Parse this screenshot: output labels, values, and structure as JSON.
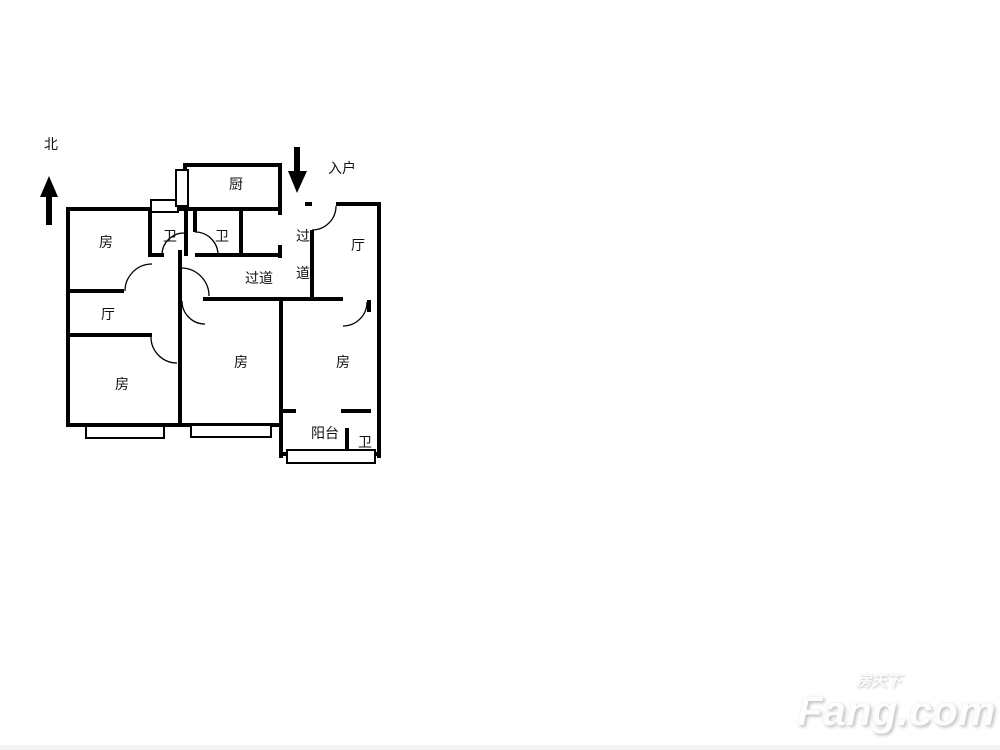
{
  "page": {
    "background": "#ffffff",
    "line_color": "#000000"
  },
  "watermark": {
    "cn": "房天下",
    "en": "Fang.com"
  },
  "plan": {
    "line_color": "#000000",
    "label_font_size": 14,
    "labels": [
      {
        "name": "north-label",
        "text": "北",
        "x": 51,
        "y": 144
      },
      {
        "name": "entry-label",
        "text": "入户",
        "x": 342,
        "y": 168
      },
      {
        "name": "kitchen-label",
        "text": "厨",
        "x": 236,
        "y": 184
      },
      {
        "name": "bath-1-label",
        "text": "卫",
        "x": 170,
        "y": 236
      },
      {
        "name": "bath-2-label",
        "text": "卫",
        "x": 222,
        "y": 236
      },
      {
        "name": "bedroom-nw-label",
        "text": "房",
        "x": 106,
        "y": 242
      },
      {
        "name": "hall-east-label",
        "text": "厅",
        "x": 358,
        "y": 245
      },
      {
        "name": "corridor-char-1",
        "text": "过",
        "x": 303,
        "y": 236
      },
      {
        "name": "corridor-char-2",
        "text": "道",
        "x": 303,
        "y": 273
      },
      {
        "name": "corridor-label",
        "text": "过道",
        "x": 259,
        "y": 278
      },
      {
        "name": "hall-west-label",
        "text": "厅",
        "x": 108,
        "y": 314
      },
      {
        "name": "bedroom-sw-label",
        "text": "房",
        "x": 122,
        "y": 384
      },
      {
        "name": "bedroom-s-label",
        "text": "房",
        "x": 241,
        "y": 362
      },
      {
        "name": "bedroom-se-label",
        "text": "房",
        "x": 343,
        "y": 362
      },
      {
        "name": "balcony-label",
        "text": "阳台",
        "x": 325,
        "y": 433
      },
      {
        "name": "bath-3-label",
        "text": "卫",
        "x": 365,
        "y": 442
      }
    ],
    "walls": [
      {
        "name": "wall-outer-left",
        "x": 66,
        "y": 207,
        "w": 4,
        "h": 220
      },
      {
        "name": "wall-nw-room-top",
        "x": 66,
        "y": 207,
        "w": 216,
        "h": 4
      },
      {
        "name": "wall-kitchen-top",
        "x": 183,
        "y": 163,
        "w": 99,
        "h": 4
      },
      {
        "name": "wall-kitchen-left-upper",
        "x": 183,
        "y": 163,
        "w": 4,
        "h": 12
      },
      {
        "name": "wall-kitchen-right-upper",
        "x": 278,
        "y": 163,
        "w": 4,
        "h": 52
      },
      {
        "name": "wall-kitchen-right-lower",
        "x": 278,
        "y": 245,
        "w": 4,
        "h": 13
      },
      {
        "name": "wall-nook-bottom",
        "x": 195,
        "y": 253,
        "w": 87,
        "h": 4
      },
      {
        "name": "wall-bath1-left",
        "x": 148,
        "y": 207,
        "w": 4,
        "h": 50
      },
      {
        "name": "wall-bath1-right",
        "x": 184,
        "y": 207,
        "w": 4,
        "h": 49
      },
      {
        "name": "wall-bath1-bottom-stub",
        "x": 148,
        "y": 253,
        "w": 16,
        "h": 4
      },
      {
        "name": "wall-bath2-left-upper",
        "x": 193,
        "y": 207,
        "w": 4,
        "h": 25
      },
      {
        "name": "wall-bath2-right",
        "x": 239,
        "y": 207,
        "w": 4,
        "h": 50
      },
      {
        "name": "wall-central-vertical",
        "x": 178,
        "y": 250,
        "w": 4,
        "h": 177
      },
      {
        "name": "wall-nw-room-bottom",
        "x": 66,
        "y": 289,
        "w": 58,
        "h": 4
      },
      {
        "name": "wall-hall-west-bottom",
        "x": 66,
        "y": 333,
        "w": 86,
        "h": 4
      },
      {
        "name": "wall-corridor-bottom",
        "x": 203,
        "y": 297,
        "w": 140,
        "h": 4
      },
      {
        "name": "wall-entry-corridor",
        "x": 310,
        "y": 230,
        "w": 4,
        "h": 70
      },
      {
        "name": "wall-east-top-a",
        "x": 305,
        "y": 202,
        "w": 7,
        "h": 4
      },
      {
        "name": "wall-east-top-b",
        "x": 336,
        "y": 202,
        "w": 45,
        "h": 4
      },
      {
        "name": "wall-outer-right",
        "x": 377,
        "y": 202,
        "w": 4,
        "h": 256
      },
      {
        "name": "wall-se-room-left",
        "x": 279,
        "y": 300,
        "w": 4,
        "h": 158
      },
      {
        "name": "wall-south-bottom",
        "x": 66,
        "y": 423,
        "w": 216,
        "h": 4
      },
      {
        "name": "wall-se-door-stub",
        "x": 367,
        "y": 300,
        "w": 4,
        "h": 12
      },
      {
        "name": "wall-balcony-top-left",
        "x": 283,
        "y": 409,
        "w": 13,
        "h": 4
      },
      {
        "name": "wall-balcony-top-right",
        "x": 341,
        "y": 409,
        "w": 30,
        "h": 4
      },
      {
        "name": "wall-balcony-bath-divider",
        "x": 345,
        "y": 428,
        "w": 4,
        "h": 26
      },
      {
        "name": "wall-balcony-bottom",
        "x": 283,
        "y": 452,
        "w": 98,
        "h": 4
      }
    ],
    "windows": [
      {
        "name": "window-bath1-top",
        "x": 151,
        "y": 200,
        "w": 27,
        "h": 12
      },
      {
        "name": "window-kitchen-left",
        "x": 176,
        "y": 170,
        "w": 12,
        "h": 36
      },
      {
        "name": "window-sw-room",
        "x": 86,
        "y": 426,
        "w": 78,
        "h": 12
      },
      {
        "name": "window-s-room",
        "x": 191,
        "y": 425,
        "w": 80,
        "h": 12
      },
      {
        "name": "window-balcony",
        "x": 287,
        "y": 450,
        "w": 88,
        "h": 13
      }
    ],
    "doors": [
      {
        "name": "door-nw-room",
        "cx": 152,
        "cy": 291,
        "r": 27,
        "a1": 180,
        "a2": 270
      },
      {
        "name": "door-bath1",
        "cx": 184,
        "cy": 255,
        "r": 22,
        "a1": 180,
        "a2": 270
      },
      {
        "name": "door-bath2",
        "cx": 195,
        "cy": 255,
        "r": 23,
        "a1": 270,
        "a2": 360
      },
      {
        "name": "door-corridor",
        "cx": 181,
        "cy": 296,
        "r": 28,
        "a1": 270,
        "a2": 360
      },
      {
        "name": "door-entry-hall",
        "cx": 312,
        "cy": 206,
        "r": 24,
        "a1": 0,
        "a2": 90
      },
      {
        "name": "door-sw-room",
        "cx": 177,
        "cy": 337,
        "r": 26,
        "a1": 90,
        "a2": 180
      },
      {
        "name": "door-s-room",
        "cx": 205,
        "cy": 301,
        "r": 23,
        "a1": 90,
        "a2": 180
      },
      {
        "name": "door-se-room",
        "cx": 343,
        "cy": 302,
        "r": 24,
        "a1": 0,
        "a2": 90
      }
    ],
    "arrows": [
      {
        "name": "north-arrow",
        "shaft": {
          "x": 46,
          "y": 195,
          "w": 6,
          "h": 30
        },
        "head": "49,176 40,197 58,197"
      },
      {
        "name": "entry-arrow",
        "shaft": {
          "x": 294,
          "y": 147,
          "w": 6,
          "h": 27
        },
        "head": "288,171 307,171 297,193"
      }
    ]
  }
}
